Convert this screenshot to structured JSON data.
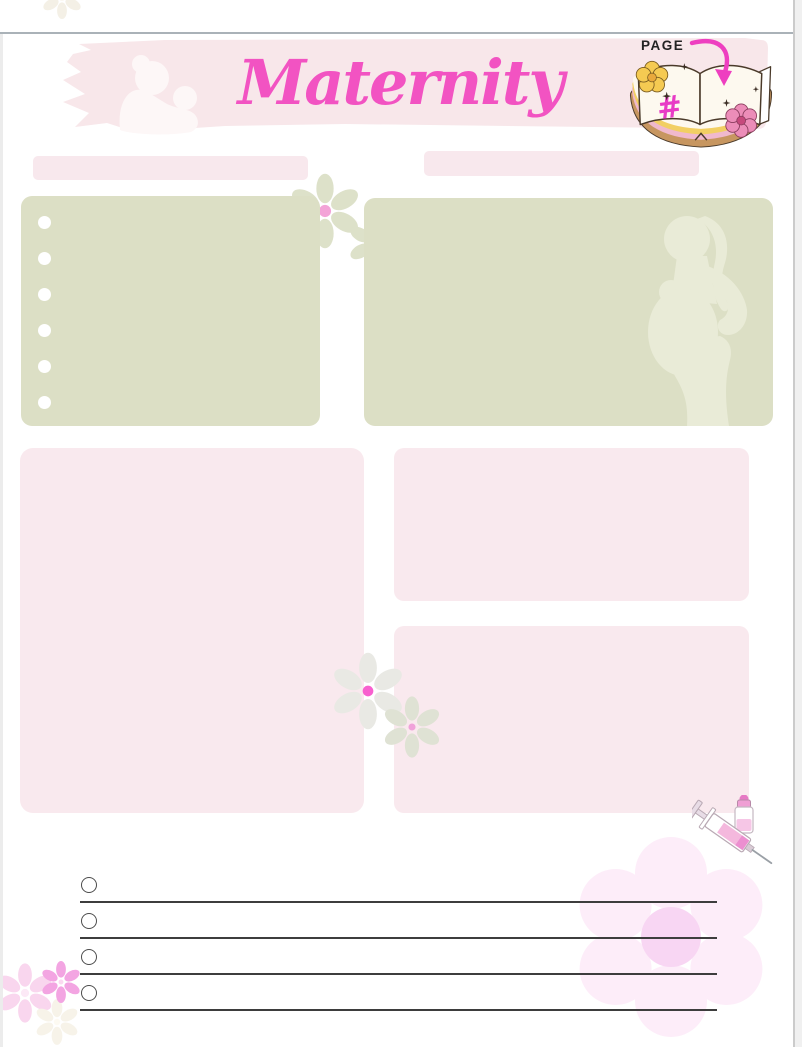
{
  "header": {
    "title": "Maternity",
    "page_label": "PAGE",
    "page_number_symbol": "#"
  },
  "fields": {
    "left_label_bar": "",
    "right_label_bar": ""
  },
  "notes_box": {
    "bullet_count": 6
  },
  "checklist": {
    "row_count": 4
  },
  "colors": {
    "title_pink": "#f253c2",
    "accent_magenta": "#ee3fc0",
    "header_band_pink": "#f8e7ea",
    "sage_green": "#dcdfc5",
    "blush_pink_box": "#f9e9ee",
    "checklist_line": "#3d3d3d",
    "big_flower_petal": "#fdedf9",
    "big_flower_center": "#f8d6f3"
  }
}
